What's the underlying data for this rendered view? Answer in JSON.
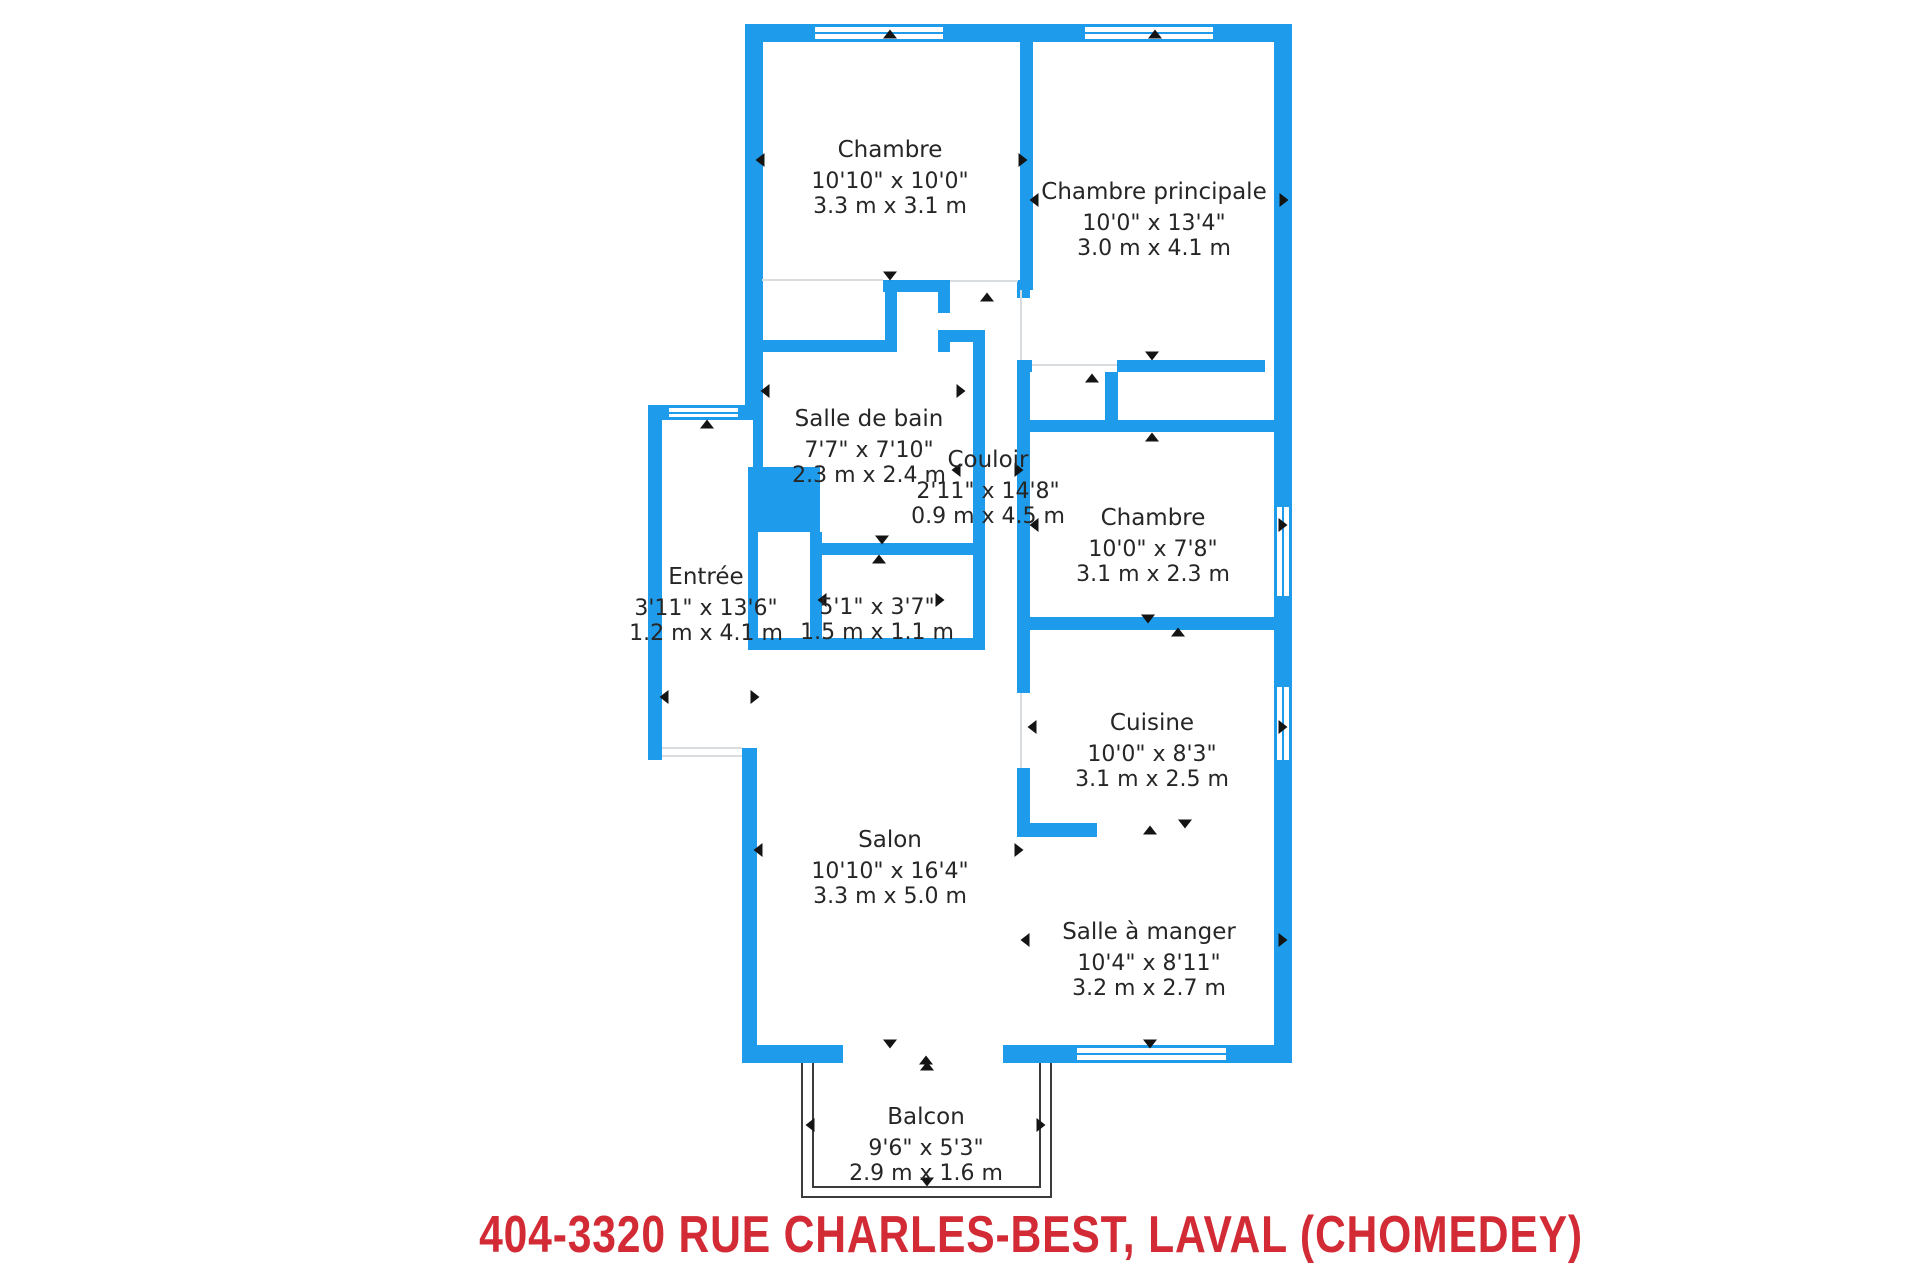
{
  "title": {
    "text": "404-3320 RUE CHARLES-BEST, LAVAL (CHOMEDEY)"
  },
  "colors": {
    "wall_blue": "#1e9ceb",
    "title_red": "#d22b35",
    "text_dark": "#262626"
  },
  "rooms": [
    {
      "id": "chambre-haut",
      "name": "Chambre",
      "imperial": "10'10\" x 10'0\"",
      "metric": "3.3 m x 3.1 m",
      "x": 890,
      "y": 137
    },
    {
      "id": "chambre-principale",
      "name": "Chambre principale",
      "imperial": "10'0\" x 13'4\"",
      "metric": "3.0 m x 4.1 m",
      "x": 1154,
      "y": 179
    },
    {
      "id": "salle-de-bain",
      "name": "Salle de bain",
      "imperial": "7'7\" x 7'10\"",
      "metric": "2.3 m x 2.4 m",
      "x": 869,
      "y": 406
    },
    {
      "id": "couloir",
      "name": "Couloir",
      "imperial": "2'11\" x 14'8\"",
      "metric": "0.9 m x 4.5 m",
      "x": 988,
      "y": 447
    },
    {
      "id": "chambre-milieu",
      "name": "Chambre",
      "imperial": "10'0\" x 7'8\"",
      "metric": "3.1 m x 2.3 m",
      "x": 1153,
      "y": 505
    },
    {
      "id": "entree",
      "name": "Entrée",
      "imperial": "3'11\" x 13'6\"",
      "metric": "1.2 m x 4.1 m",
      "x": 706,
      "y": 564
    },
    {
      "id": "rangement",
      "name": "",
      "imperial": "5'1\" x 3'7\"",
      "metric": "1.5 m x 1.1 m",
      "x": 877,
      "y": 595
    },
    {
      "id": "cuisine",
      "name": "Cuisine",
      "imperial": "10'0\" x 8'3\"",
      "metric": "3.1 m x 2.5 m",
      "x": 1152,
      "y": 710
    },
    {
      "id": "salon",
      "name": "Salon",
      "imperial": "10'10\" x 16'4\"",
      "metric": "3.3 m x 5.0 m",
      "x": 890,
      "y": 827
    },
    {
      "id": "salle-a-manger",
      "name": "Salle à manger",
      "imperial": "10'4\" x 8'11\"",
      "metric": "3.2 m x 2.7 m",
      "x": 1149,
      "y": 919
    },
    {
      "id": "balcon",
      "name": "Balcon",
      "imperial": "9'6\" x 5'3\"",
      "metric": "2.9 m x 1.6 m",
      "x": 926,
      "y": 1104
    }
  ]
}
